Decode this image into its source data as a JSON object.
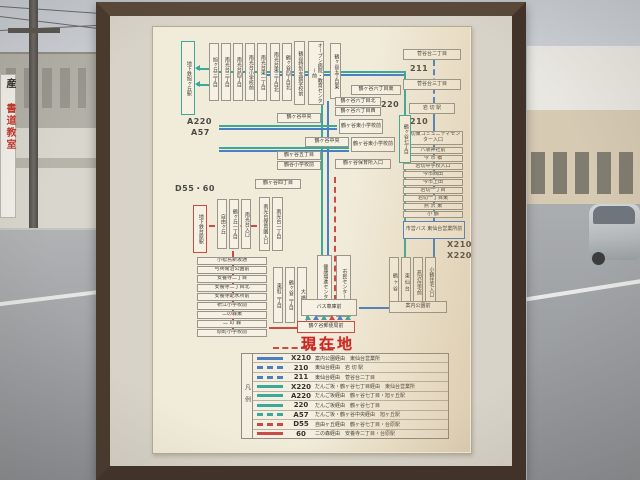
{
  "scene": {
    "left_sign_char": "産",
    "left_sign_text": "書道教室"
  },
  "map": {
    "current_location": "現在地",
    "colors": {
      "blue": "#4a7fc1",
      "teal": "#3aa99a",
      "red": "#c94b44"
    },
    "labels": [
      {
        "text": "A220",
        "x": 34,
        "y": 90
      },
      {
        "text": "A57",
        "x": 38,
        "y": 101
      },
      {
        "text": "D55・60",
        "x": 22,
        "y": 156
      },
      {
        "text": "220",
        "x": 228,
        "y": 73
      },
      {
        "text": "211",
        "x": 257,
        "y": 37
      },
      {
        "text": "210",
        "x": 257,
        "y": 90
      },
      {
        "text": "X210",
        "x": 294,
        "y": 213
      },
      {
        "text": "X220",
        "x": 294,
        "y": 224
      }
    ],
    "nodes": [
      {
        "t": "地下鉄旭ヶ丘駅",
        "x": 28,
        "y": 14,
        "w": 14,
        "h": 74,
        "v": 1,
        "b": "teal"
      },
      {
        "t": "旭ヶ丘三丁目",
        "x": 56,
        "y": 16,
        "w": 10,
        "h": 58,
        "v": 1
      },
      {
        "t": "南光台三丁目",
        "x": 68,
        "y": 16,
        "w": 10,
        "h": 58,
        "v": 1
      },
      {
        "t": "南光台四丁目",
        "x": 80,
        "y": 16,
        "w": 10,
        "h": 58,
        "v": 1
      },
      {
        "t": "南光台小学校前",
        "x": 92,
        "y": 16,
        "w": 10,
        "h": 58,
        "v": 1
      },
      {
        "t": "南光台東一丁目",
        "x": 104,
        "y": 16,
        "w": 10,
        "h": 58,
        "v": 1
      },
      {
        "t": "南光台東三丁目北",
        "x": 117,
        "y": 16,
        "w": 10,
        "h": 58,
        "v": 1
      },
      {
        "t": "鶴ヶ谷四丁目北",
        "x": 129,
        "y": 16,
        "w": 10,
        "h": 58,
        "v": 1
      },
      {
        "t": "鶴谷特別支援学校前",
        "x": 141,
        "y": 14,
        "w": 11,
        "h": 64,
        "v": 1
      },
      {
        "t": "オープン病院・教育センター前",
        "x": 155,
        "y": 14,
        "w": 16,
        "h": 64,
        "v": 1
      },
      {
        "t": "鶴ヶ谷五丁目東",
        "x": 177,
        "y": 16,
        "w": 11,
        "h": 56,
        "v": 1
      },
      {
        "t": "菅谷台二丁目",
        "x": 250,
        "y": 22,
        "w": 58,
        "h": 11
      },
      {
        "t": "菅谷台三丁目",
        "x": 250,
        "y": 52,
        "w": 58,
        "h": 11
      },
      {
        "t": "岩 切 駅",
        "x": 256,
        "y": 76,
        "w": 46,
        "h": 11
      },
      {
        "t": "岩切東コミュニティセンター入口",
        "x": 250,
        "y": 104,
        "w": 60,
        "h": 14
      },
      {
        "t": "八坂神社前",
        "x": 250,
        "y": 120,
        "w": 60,
        "h": 7
      },
      {
        "t": "今 市 橋",
        "x": 250,
        "y": 128,
        "w": 60,
        "h": 7
      },
      {
        "t": "岩切中学校入口",
        "x": 250,
        "y": 136,
        "w": 60,
        "h": 7
      },
      {
        "t": "今市西田",
        "x": 250,
        "y": 144,
        "w": 60,
        "h": 7
      },
      {
        "t": "今市上田",
        "x": 250,
        "y": 152,
        "w": 60,
        "h": 7
      },
      {
        "t": "岩切一丁目",
        "x": 250,
        "y": 160,
        "w": 60,
        "h": 7
      },
      {
        "t": "岩切一丁目東",
        "x": 250,
        "y": 168,
        "w": 60,
        "h": 7
      },
      {
        "t": "燕 沢 東",
        "x": 250,
        "y": 176,
        "w": 60,
        "h": 7
      },
      {
        "t": "小 鶴",
        "x": 250,
        "y": 184,
        "w": 60,
        "h": 7
      },
      {
        "t": "市営バス 東仙台営業所前",
        "x": 250,
        "y": 194,
        "w": 62,
        "h": 18,
        "b": "blue"
      },
      {
        "t": "鶴ヶ谷六丁目東",
        "x": 198,
        "y": 58,
        "w": 50,
        "h": 10
      },
      {
        "t": "鶴ヶ谷六丁目北",
        "x": 182,
        "y": 70,
        "w": 46,
        "h": 9
      },
      {
        "t": "鶴ヶ谷六丁目西",
        "x": 182,
        "y": 80,
        "w": 46,
        "h": 9
      },
      {
        "t": "鶴ヶ谷七丁目",
        "x": 246,
        "y": 88,
        "w": 12,
        "h": 48,
        "v": 1,
        "b": "teal"
      },
      {
        "t": "鶴ヶ谷東小学校前",
        "x": 186,
        "y": 92,
        "w": 44,
        "h": 15
      },
      {
        "t": "鶴ヶ谷中央",
        "x": 124,
        "y": 86,
        "w": 44,
        "h": 10
      },
      {
        "t": "鶴ヶ谷中央",
        "x": 152,
        "y": 110,
        "w": 44,
        "h": 10
      },
      {
        "t": "鶴ヶ谷東小学校前",
        "x": 198,
        "y": 110,
        "w": 44,
        "h": 15
      },
      {
        "t": "鶴ヶ谷五丁目",
        "x": 124,
        "y": 124,
        "w": 44,
        "h": 9
      },
      {
        "t": "鶴谷小学校前",
        "x": 124,
        "y": 134,
        "w": 44,
        "h": 9
      },
      {
        "t": "鶴ヶ谷保育所入口",
        "x": 182,
        "y": 132,
        "w": 56,
        "h": 10
      },
      {
        "t": "鶴ヶ谷四丁目",
        "x": 102,
        "y": 152,
        "w": 46,
        "h": 10
      },
      {
        "t": "地下鉄台原駅",
        "x": 40,
        "y": 178,
        "w": 14,
        "h": 48,
        "v": 1,
        "b": "red"
      },
      {
        "t": "自由ヶ丘",
        "x": 64,
        "y": 172,
        "w": 10,
        "h": 50,
        "v": 1
      },
      {
        "t": "鶴ヶ丘一丁目",
        "x": 76,
        "y": 172,
        "w": 10,
        "h": 50,
        "v": 1
      },
      {
        "t": "南光台入口",
        "x": 88,
        "y": 172,
        "w": 10,
        "h": 50,
        "v": 1
      },
      {
        "t": "南光台保育園入口",
        "x": 106,
        "y": 170,
        "w": 11,
        "h": 54,
        "v": 1
      },
      {
        "t": "南光台一丁目",
        "x": 119,
        "y": 170,
        "w": 11,
        "h": 54,
        "v": 1
      },
      {
        "t": "小松島新坂通",
        "x": 44,
        "y": 230,
        "w": 70,
        "h": 8
      },
      {
        "t": "与兵衛沼公園前",
        "x": 44,
        "y": 239,
        "w": 70,
        "h": 8
      },
      {
        "t": "安養寺二丁目",
        "x": 44,
        "y": 248,
        "w": 70,
        "h": 8
      },
      {
        "t": "安養寺二丁目北",
        "x": 44,
        "y": 257,
        "w": 70,
        "h": 8
      },
      {
        "t": "安養寺配水所前",
        "x": 44,
        "y": 266,
        "w": 70,
        "h": 8
      },
      {
        "t": "枡江小学校前",
        "x": 44,
        "y": 275,
        "w": 70,
        "h": 8
      },
      {
        "t": "二の森東",
        "x": 44,
        "y": 284,
        "w": 70,
        "h": 8
      },
      {
        "t": "二 の 森",
        "x": 44,
        "y": 293,
        "w": 70,
        "h": 8
      },
      {
        "t": "原町小学校前",
        "x": 44,
        "y": 302,
        "w": 70,
        "h": 8
      },
      {
        "t": "東町二丁目",
        "x": 120,
        "y": 240,
        "w": 10,
        "h": 56,
        "v": 1
      },
      {
        "t": "鶴ヶ谷二丁目",
        "x": 132,
        "y": 240,
        "w": 10,
        "h": 56,
        "v": 1
      },
      {
        "t": "大 橋",
        "x": 144,
        "y": 240,
        "w": 10,
        "h": 56,
        "v": 1
      },
      {
        "t": "健康増進センター前",
        "x": 164,
        "y": 228,
        "w": 15,
        "h": 62,
        "v": 1
      },
      {
        "t": "市民センター前",
        "x": 183,
        "y": 228,
        "w": 15,
        "h": 62,
        "v": 1
      },
      {
        "t": "鶴 ヶ 谷",
        "x": 236,
        "y": 230,
        "w": 10,
        "h": 50,
        "v": 1
      },
      {
        "t": "東 仙 台",
        "x": 248,
        "y": 230,
        "w": 10,
        "h": 50,
        "v": 1
      },
      {
        "t": "燕沢住宅前",
        "x": 260,
        "y": 230,
        "w": 10,
        "h": 50,
        "v": 1
      },
      {
        "t": "小鶴住宅入口",
        "x": 272,
        "y": 230,
        "w": 11,
        "h": 50,
        "v": 1
      },
      {
        "t": "バス車庫前",
        "x": 148,
        "y": 272,
        "w": 56,
        "h": 17
      },
      {
        "t": "案内公園前",
        "x": 236,
        "y": 274,
        "w": 58,
        "h": 12
      },
      {
        "t": "鶴ケ谷郵便局前",
        "x": 144,
        "y": 294,
        "w": 58,
        "h": 12,
        "b": "red"
      }
    ],
    "lines": [
      {
        "x": 44,
        "y": 41,
        "w": 12,
        "c": "teal"
      },
      {
        "x": 44,
        "y": 57,
        "w": 12,
        "c": "teal"
      },
      {
        "x": 56,
        "y": 44,
        "w": 196,
        "c": "teal"
      },
      {
        "x": 104,
        "y": 47,
        "w": 148,
        "c": "blue"
      },
      {
        "x": 168,
        "y": 74,
        "h": 200,
        "c": "teal",
        "v": 1
      },
      {
        "x": 174,
        "y": 74,
        "h": 200,
        "c": "blue",
        "v": 1
      },
      {
        "x": 181,
        "y": 150,
        "h": 124,
        "c": "red",
        "v": 1,
        "d": 1
      },
      {
        "x": 66,
        "y": 98,
        "w": 118,
        "c": "teal"
      },
      {
        "x": 66,
        "y": 101,
        "w": 118,
        "c": "blue"
      },
      {
        "x": 66,
        "y": 120,
        "w": 130,
        "c": "teal"
      },
      {
        "x": 66,
        "y": 123,
        "w": 130,
        "c": "blue"
      },
      {
        "x": 251,
        "y": 44,
        "h": 44,
        "c": "teal",
        "v": 1
      },
      {
        "x": 251,
        "y": 136,
        "h": 94,
        "c": "teal",
        "v": 1
      },
      {
        "x": 280,
        "y": 33,
        "h": 43,
        "c": "blue",
        "v": 1,
        "d": 1
      },
      {
        "x": 280,
        "y": 87,
        "h": 107,
        "c": "blue",
        "v": 1
      },
      {
        "x": 280,
        "y": 212,
        "h": 62,
        "c": "blue",
        "v": 1
      },
      {
        "x": 206,
        "y": 280,
        "w": 30,
        "c": "blue"
      },
      {
        "x": 56,
        "y": 198,
        "w": 48,
        "c": "red",
        "d": 1
      },
      {
        "x": 79,
        "y": 224,
        "h": 80,
        "c": "red",
        "v": 1
      },
      {
        "x": 116,
        "y": 300,
        "w": 28,
        "c": "red"
      },
      {
        "x": 120,
        "y": 320,
        "w": 62,
        "c": "red",
        "d": 1
      }
    ],
    "arrows": [
      {
        "x": 42,
        "y": 38,
        "dir": "left",
        "c": "teal"
      },
      {
        "x": 42,
        "y": 54,
        "dir": "left",
        "c": "teal"
      },
      {
        "x": 152,
        "y": 288,
        "dir": "up",
        "c": "teal"
      },
      {
        "x": 160,
        "y": 288,
        "dir": "up",
        "c": "blue"
      },
      {
        "x": 168,
        "y": 288,
        "dir": "up",
        "c": "teal"
      },
      {
        "x": 176,
        "y": 288,
        "dir": "up",
        "c": "red"
      },
      {
        "x": 184,
        "y": 288,
        "dir": "up",
        "c": "blue"
      },
      {
        "x": 192,
        "y": 288,
        "dir": "up",
        "c": "teal"
      }
    ],
    "legend": {
      "title": "凡例",
      "box": {
        "x": 88,
        "y": 326,
        "w": 208,
        "h": 86
      },
      "rows": [
        {
          "no": "X210",
          "color": "blue",
          "dashed": false,
          "desc": "案内公園経由　東仙台営業所"
        },
        {
          "no": "210",
          "color": "blue",
          "dashed": true,
          "desc": "東仙台経由　岩 切 駅"
        },
        {
          "no": "211",
          "color": "blue",
          "dashed": true,
          "desc": "東仙台経由　菅谷台二丁目"
        },
        {
          "no": "X220",
          "color": "teal",
          "dashed": false,
          "desc": "だんご坂・鶴ヶ谷七丁目経由　東仙台営業所"
        },
        {
          "no": "A220",
          "color": "teal",
          "dashed": false,
          "desc": "だんご坂経由　鶴ヶ谷七丁目・旭ヶ丘駅"
        },
        {
          "no": "220",
          "color": "teal",
          "dashed": false,
          "desc": "だんご坂経由　鶴ヶ谷七丁目"
        },
        {
          "no": "A57",
          "color": "teal",
          "dashed": true,
          "desc": "だんご坂・鶴ヶ谷中央経由　旭ヶ丘駅"
        },
        {
          "no": "D55",
          "color": "red",
          "dashed": true,
          "desc": "自由ヶ丘経由　鶴ヶ谷七丁目・台原駅"
        },
        {
          "no": "60",
          "color": "red",
          "dashed": false,
          "desc": "二の森経由　安養寺二丁目・台原駅"
        }
      ]
    },
    "current_location_pos": {
      "x": 148,
      "y": 306
    }
  }
}
